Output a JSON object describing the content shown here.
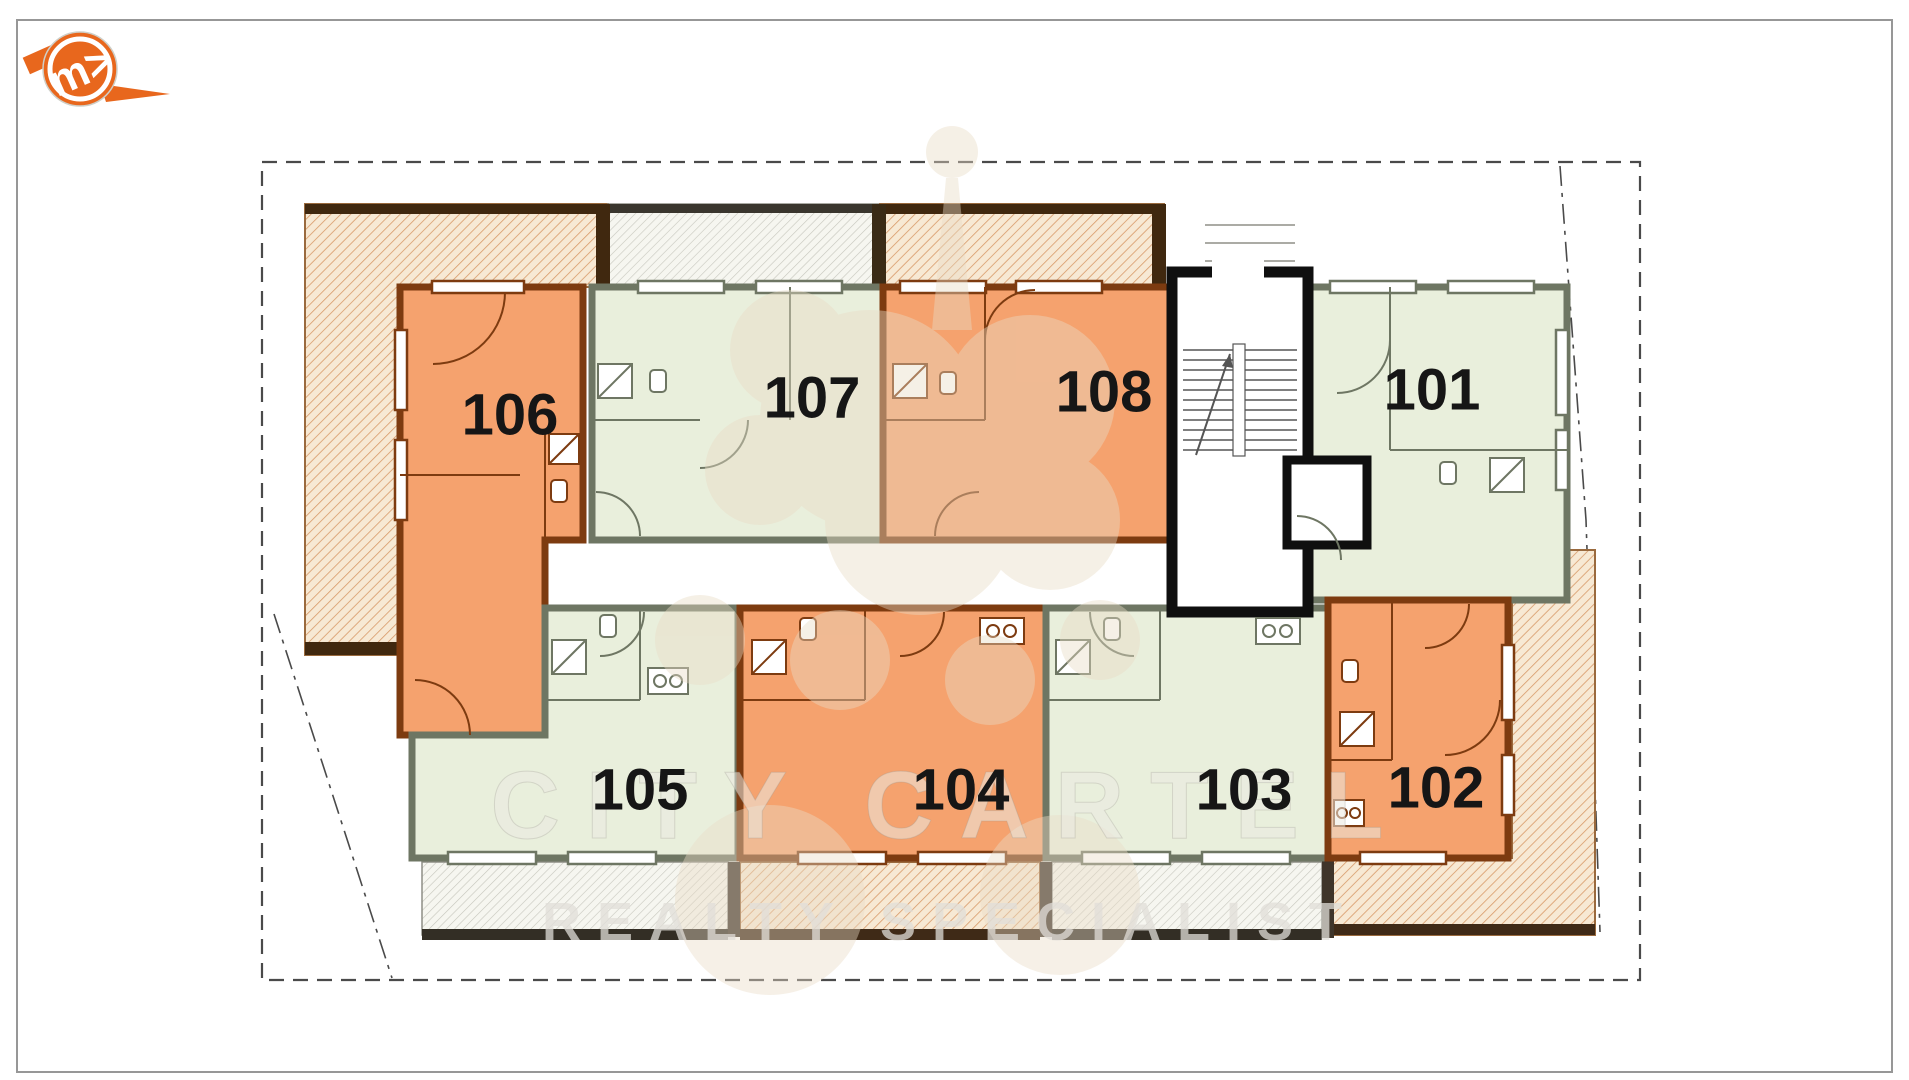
{
  "logo": {
    "monogram": "m>"
  },
  "watermark": {
    "line1": "CITY CARTEL",
    "line2": "REALTY SPECIALIST"
  },
  "units": [
    {
      "number": "101",
      "fill": "#E9EFDC",
      "wall": "#6E7663"
    },
    {
      "number": "102",
      "fill": "#F5A26E",
      "wall": "#7D3B10"
    },
    {
      "number": "103",
      "fill": "#E9EFDC",
      "wall": "#6E7663"
    },
    {
      "number": "104",
      "fill": "#F5A26E",
      "wall": "#7D3B10"
    },
    {
      "number": "105",
      "fill": "#E9EFDC",
      "wall": "#6E7663"
    },
    {
      "number": "106",
      "fill": "#F5A26E",
      "wall": "#7D3B10"
    },
    {
      "number": "107",
      "fill": "#E9EFDC",
      "wall": "#6E7663"
    },
    {
      "number": "108",
      "fill": "#F5A26E",
      "wall": "#7D3B10"
    }
  ],
  "colors": {
    "terrace_bg": "#F7E9D4",
    "terrace_line": "#D89A69",
    "balcony_bg": "#F6F6F0",
    "balcony_line": "#C6C6BD",
    "boundary": "#4A4A4A",
    "stair_wall": "#0F0F0F",
    "logo_orange": "#E8671D",
    "dark_band_orange": "#40280F",
    "dark_band_gray": "#3A362E"
  }
}
